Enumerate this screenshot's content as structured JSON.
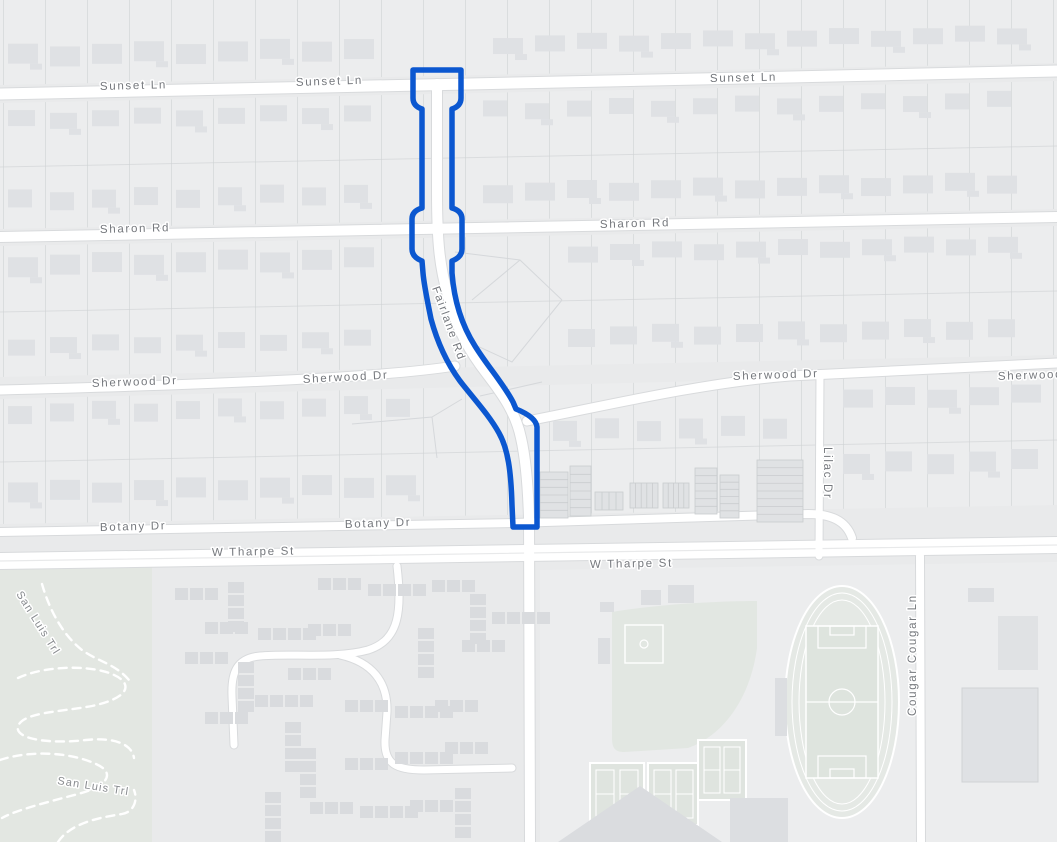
{
  "map": {
    "type": "street-map",
    "highlighted_street": "Fairlane Rd",
    "route": {
      "color": "#0b57d0"
    },
    "colors": {
      "background": "#e9eaeb",
      "block": "#ecedee",
      "park_green": "#e3e7e2",
      "field_green": "#dfe4df",
      "road_white": "#ffffff",
      "road_casing": "#d8dadc",
      "building_gray": "#dfe1e4",
      "lot_line": "#cfd2d4",
      "label_gray": "#75787d"
    },
    "labels": [
      {
        "id": "sunset-ln-west",
        "text": "Sunset Ln"
      },
      {
        "id": "sunset-ln-center",
        "text": "Sunset Ln"
      },
      {
        "id": "sunset-ln-east",
        "text": "Sunset Ln"
      },
      {
        "id": "sharon-rd-west",
        "text": "Sharon Rd"
      },
      {
        "id": "sharon-rd-east",
        "text": "Sharon Rd"
      },
      {
        "id": "fairlane-rd",
        "text": "Fairlane Rd"
      },
      {
        "id": "sherwood-dr-w1",
        "text": "Sherwood Dr"
      },
      {
        "id": "sherwood-dr-w2",
        "text": "Sherwood Dr"
      },
      {
        "id": "sherwood-dr-e1",
        "text": "Sherwood Dr"
      },
      {
        "id": "sherwood-dr-e2",
        "text": "Sherwood Dr"
      },
      {
        "id": "botany-dr-west",
        "text": "Botany Dr"
      },
      {
        "id": "botany-dr-east",
        "text": "Botany Dr"
      },
      {
        "id": "w-tharpe-st-west",
        "text": "W Tharpe St"
      },
      {
        "id": "w-tharpe-st-east",
        "text": "W Tharpe St"
      },
      {
        "id": "lilac-dr",
        "text": "Lilac Dr"
      },
      {
        "id": "cougar-ln",
        "text": "Cougar Cougar Ln"
      },
      {
        "id": "san-luis-trl-1",
        "text": "San Luis Trl"
      },
      {
        "id": "san-luis-trl-2",
        "text": "San Luis Trl"
      }
    ]
  }
}
